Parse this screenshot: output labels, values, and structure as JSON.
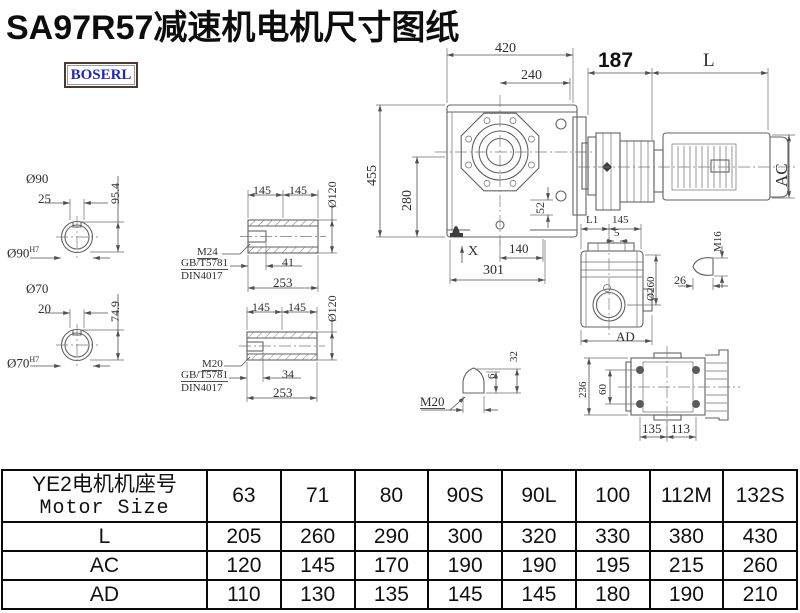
{
  "title": "SA97R57减速机电机尺寸图纸",
  "logo": "BOSERL",
  "drawing": {
    "shaft90": {
      "dia": "Ø90",
      "key": "25",
      "h": "95.4",
      "bore": "Ø90",
      "tol": "H7"
    },
    "shaft70": {
      "dia": "Ø70",
      "key": "20",
      "h": "74.9",
      "bore": "Ø70",
      "tol": "H7"
    },
    "hollow1": {
      "l1": "145",
      "l2": "145",
      "dia": "Ø120",
      "thread": "M24",
      "std1": "GB/T5781",
      "std2": "DIN4017",
      "depth": "41",
      "len": "253"
    },
    "hollow2": {
      "l1": "145",
      "l2": "145",
      "dia": "Ø120",
      "thread": "M20",
      "std1": "GB/T5781",
      "std2": "DIN4017",
      "depth": "34",
      "len": "253"
    },
    "main": {
      "w": "420",
      "fw": "240",
      "h": "455",
      "ch": "280",
      "off": "52",
      "x": "X",
      "foot": "140",
      "base": "301"
    },
    "motor": {
      "adapter": "187",
      "len": "L",
      "dia": "AC"
    },
    "side": {
      "l1": "L1",
      "w": "145",
      "t": "5",
      "dia": "Ø260",
      "ad": "AD"
    },
    "boltM16": {
      "thread": "M16",
      "len": "26"
    },
    "boltM20": {
      "thread": "M20",
      "d6": "6",
      "d32": "32"
    },
    "rear": {
      "h": "236",
      "s": "60",
      "f1": "135",
      "f2": "113"
    }
  },
  "table": {
    "header_cn": "YE2电机机座号",
    "header_en": "Motor Size",
    "columns": [
      "63",
      "71",
      "80",
      "90S",
      "90L",
      "100",
      "112M",
      "132S"
    ],
    "rows": [
      {
        "label": "L",
        "values": [
          "205",
          "260",
          "290",
          "300",
          "320",
          "330",
          "380",
          "430"
        ]
      },
      {
        "label": "AC",
        "values": [
          "120",
          "145",
          "170",
          "190",
          "190",
          "195",
          "215",
          "260"
        ]
      },
      {
        "label": "AD",
        "values": [
          "110",
          "130",
          "135",
          "145",
          "145",
          "180",
          "190",
          "210"
        ]
      }
    ]
  }
}
